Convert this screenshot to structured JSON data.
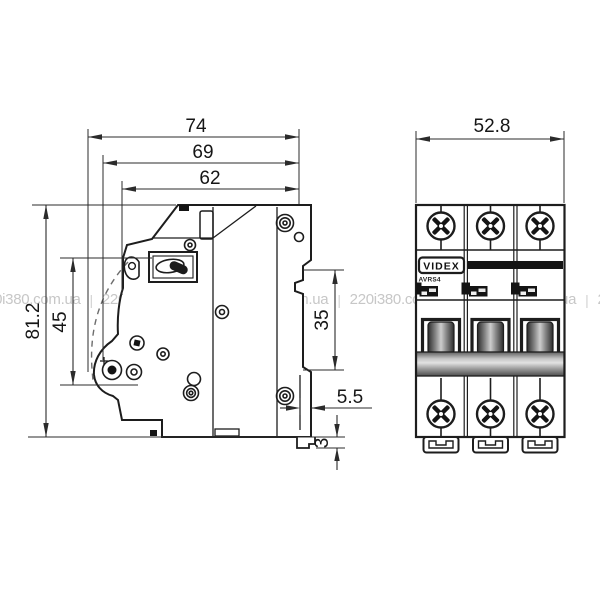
{
  "watermark": {
    "text": "220i380.com.ua",
    "separator": "|"
  },
  "side_view": {
    "dimensions": {
      "depth_total": "74",
      "depth_mid": "69",
      "depth_front": "62",
      "height_total": "81.2",
      "height_front": "45",
      "din_slot": "35",
      "clip_offset": "5.5",
      "hook_height": "3"
    }
  },
  "front_view": {
    "dimensions": {
      "width_total": "52.8"
    },
    "brand": "VIDEX",
    "model": "AVRS4"
  },
  "colors": {
    "outline": "#1d1d1d",
    "dimension_line": "#333333",
    "watermark": "#c7c7c7",
    "lever_dark": "#2b2b2b",
    "bar_gray": "#9a9a9a"
  }
}
